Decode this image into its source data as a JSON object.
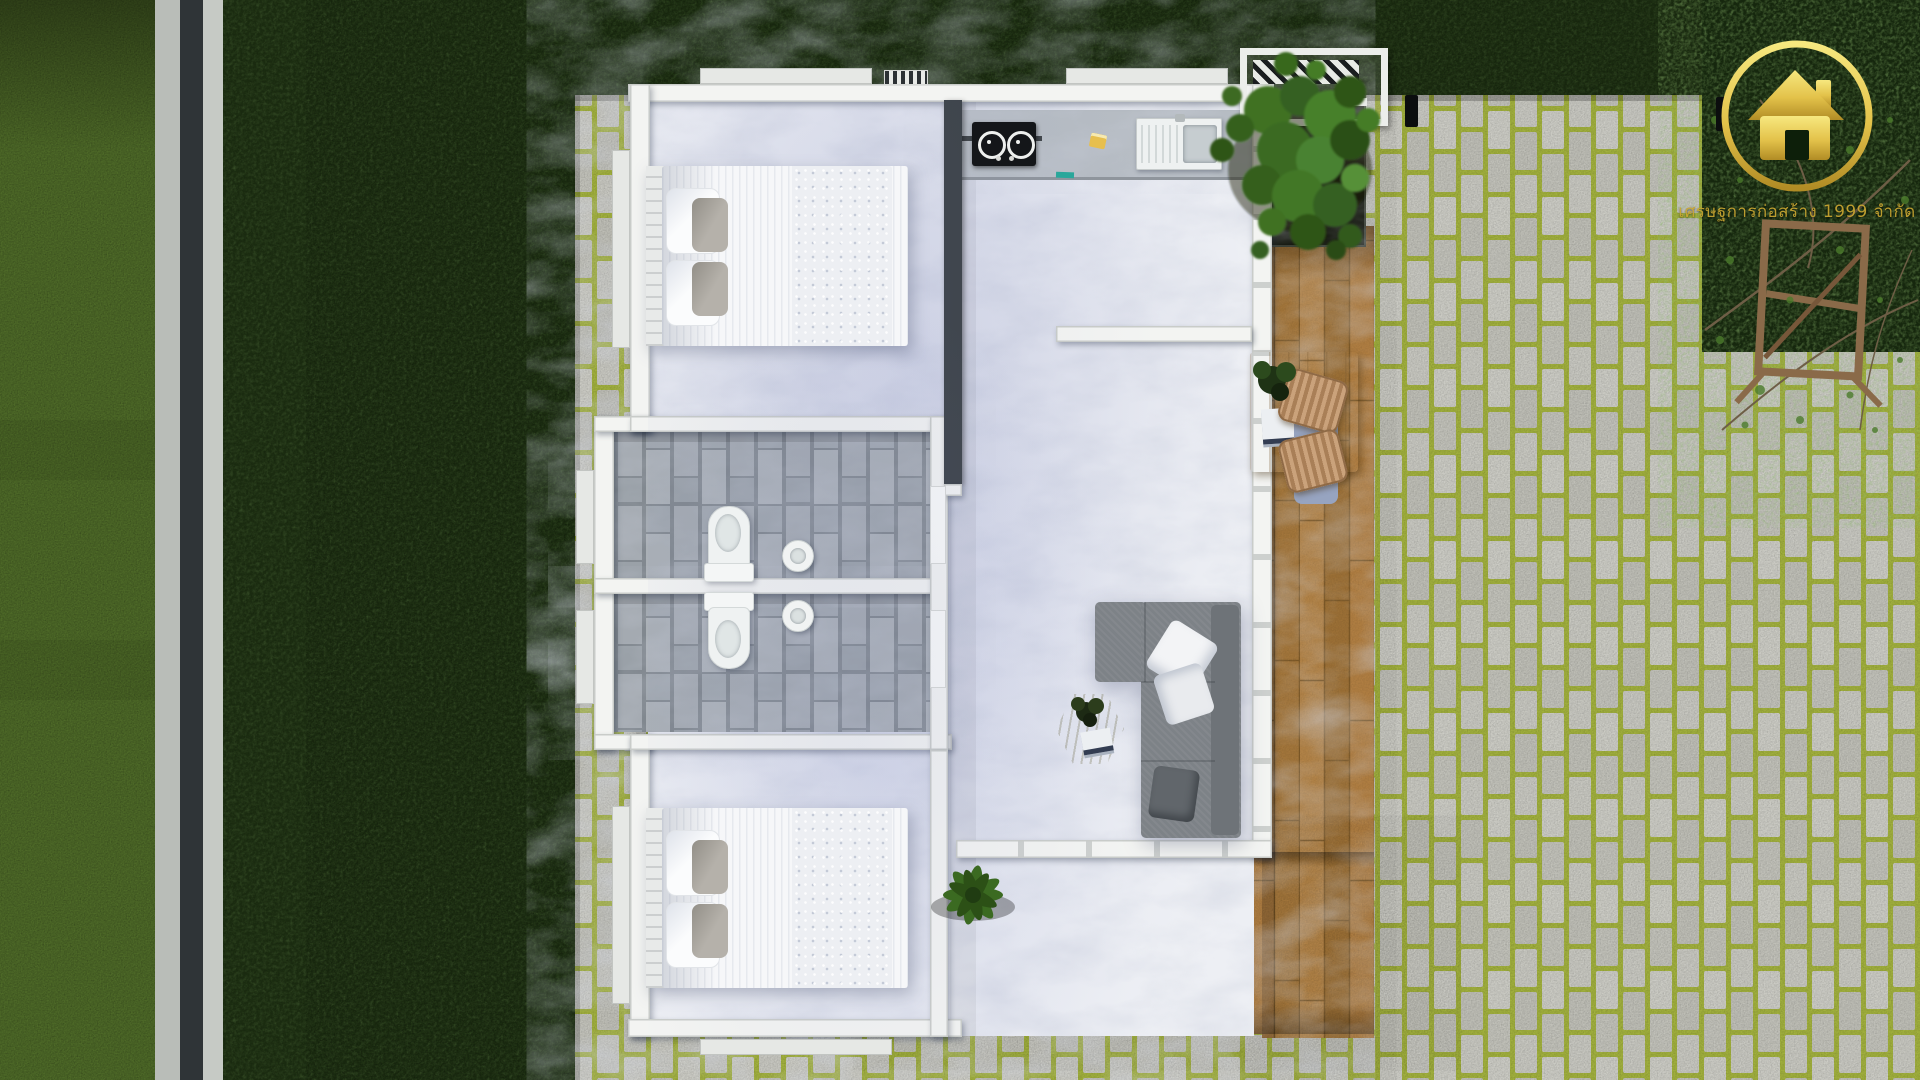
{
  "scene": {
    "title": "Top-down 3D render of a one-storey house with garden, stone pavers and wooden deck",
    "areas": [
      "lawn",
      "boundary wall",
      "bright grass verge",
      "stone paver walkway with moss joints",
      "bedroom top",
      "kitchen",
      "hallway",
      "bathroom upper",
      "bathroom lower",
      "bedroom bottom",
      "living room",
      "wooden deck",
      "planter with climbing plant and pergola",
      "garden corner with tree branches and wooden trellis"
    ]
  },
  "branding": {
    "logo_icon": "gold-house-circle-logo",
    "watermark_text": "เศรษฐการก่อสร้าง 1999 จำกัด"
  },
  "furniture": {
    "bedroom_top": "double bed, white striped duvet, two white and two grey pillows",
    "bedroom_bottom": "double bed, white striped duvet, two white and two grey pillows",
    "kitchen": "black two-burner gas hob, sink with drainboard, yellow sponge, green cloth",
    "bathrooms": "two toilets back-to-back on divider wall, two round pedestal basins",
    "living_room": "grey L-shaped sectional sofa, white and grey cushions, hexagonal wooden coffee table with plant and magazine",
    "deck": "light-wood dining table with plant and books, two rattan chairs with blue cushions, potted plant",
    "garden": "climbing plant over pergola slats, wooden trellis frame, two ground spotlights"
  },
  "palette": {
    "lawn_dark": "#1d2f12",
    "grass_bright": "#4e6a28",
    "paver_stone": "#c6c6bf",
    "paver_moss": "#a2b13e",
    "deck_wood": "#a87a3e",
    "marble": "#edeff4",
    "bath_tile": "#a4aab1",
    "wall_white": "#f3f4f2",
    "wall_dark": "#3c4247",
    "sofa_gray": "#7d8287",
    "gold": "#c9a631",
    "foliage": "#3f7124"
  }
}
